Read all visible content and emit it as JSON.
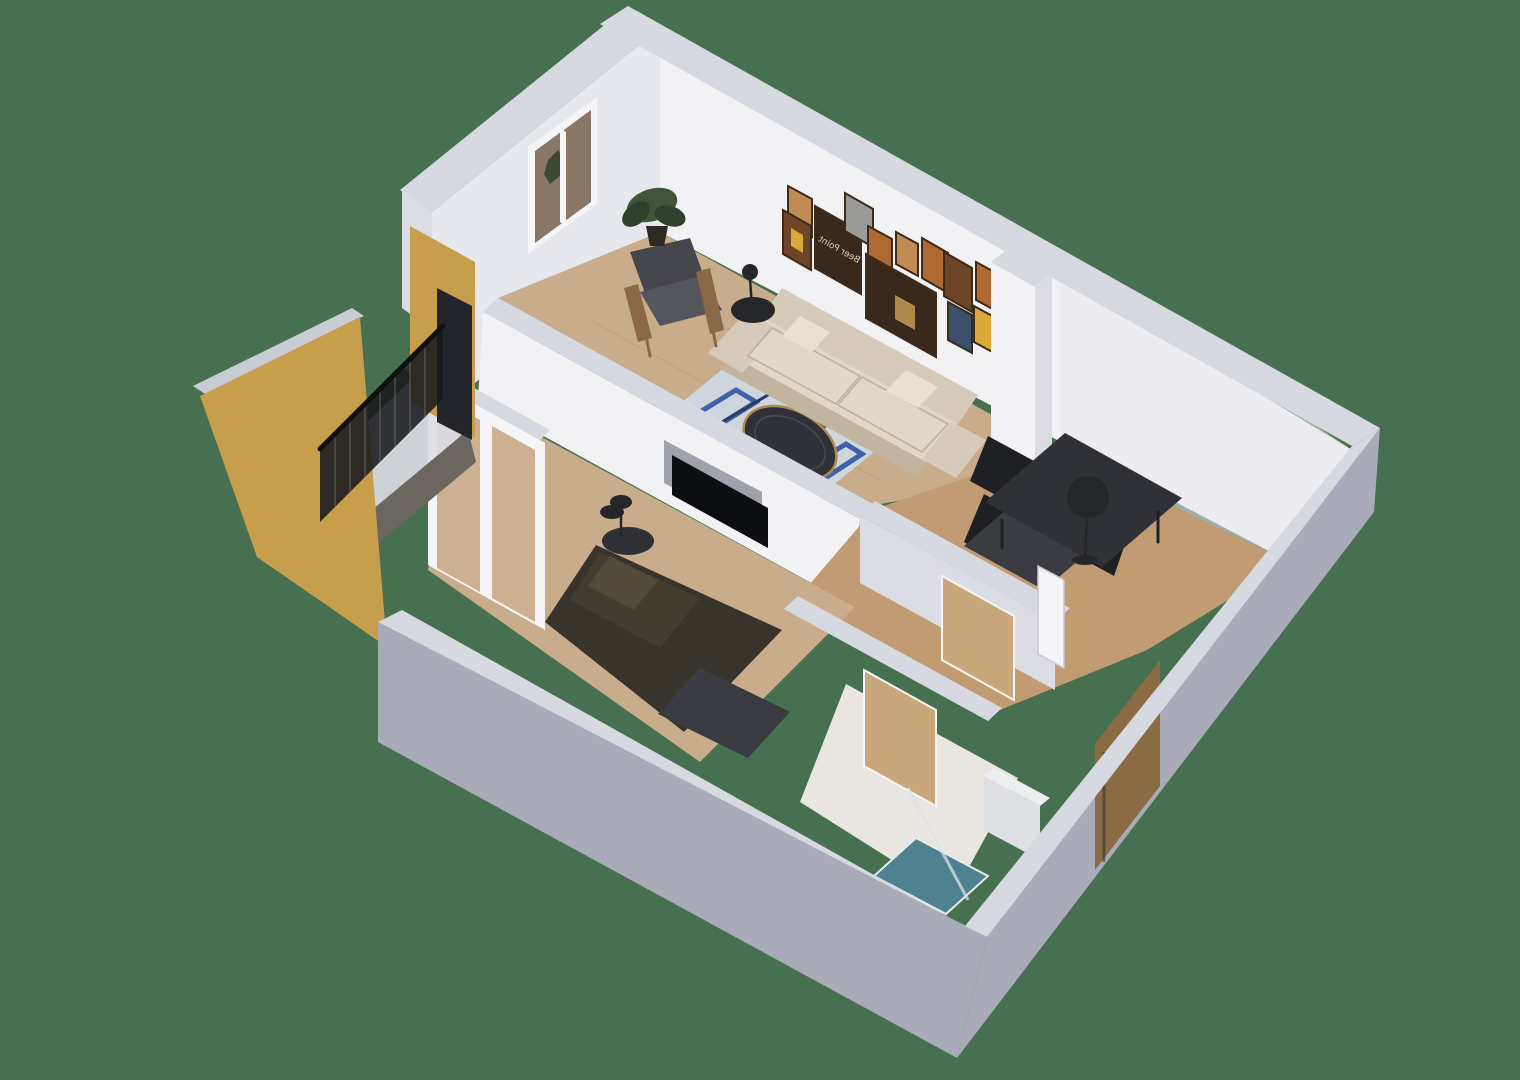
{
  "scene": {
    "title": "3D apartment dollhouse floor-plan render",
    "background_color": "#46704F",
    "wall_art_text": "Beer Point",
    "rooms": [
      {
        "name": "living-room",
        "furniture": [
          "beige sofa",
          "leather armchair",
          "floor lamp",
          "round coffee table",
          "patterned rug",
          "potted plant",
          "gallery wall posters",
          "window"
        ]
      },
      {
        "name": "dining-area",
        "furniture": [
          "dark dining table",
          "bench",
          "black chairs",
          "floor lamp"
        ]
      },
      {
        "name": "bedroom",
        "furniture": [
          "dark bed",
          "wall tv niche",
          "round side table",
          "table lamp",
          "foot bench",
          "sliding balcony door"
        ]
      },
      {
        "name": "bathroom",
        "furniture": [
          "teal shower tray",
          "white cabinet",
          "open wooden doors",
          "marble floor"
        ]
      },
      {
        "name": "hallway",
        "furniture": [
          "white door",
          "wooden entry door"
        ]
      },
      {
        "name": "balcony",
        "furniture": [
          "black metal railing",
          "yellow exterior walls"
        ]
      }
    ],
    "colors": {
      "bg": "#46704F",
      "wall_top": "#D7D9E1",
      "wall_top_dim": "#C9CBD5",
      "wall_inner": "#F2F2F5",
      "wall_inner_dim": "#E7E8ED",
      "wall_inner_shade": "#DCDDE4",
      "wall_outer": "#A9ACB8",
      "wall_outer_dark": "#999CA8",
      "yellow": "#C79E4B",
      "floor_wood": "#C9AC8B",
      "floor_wood_dim": "#C19B72",
      "floor_marble": "#E9E6E2",
      "plank": "#B3946F",
      "balcony_floor": "#6B665F",
      "rug_base": "#CFD5DD",
      "rug_blue": "#3E62A6",
      "rug_navy": "#2C3C5E",
      "sofa": "#D6CBBA",
      "sofa_light": "#E0D7C7",
      "sofa_shade": "#C2B5A0",
      "pillow": "#E8E0D1",
      "armchair": "#45464B",
      "armchair_light": "#55565C",
      "wood": "#8A6848",
      "bed": "#38332B",
      "bed_light": "#514A3A",
      "bench_dark": "#3A3C42",
      "table_dark": "#2F3137",
      "chair_black": "#1E2024",
      "lamp_black": "#26272B",
      "tv": "#0D0E11",
      "niche": "#9FA1AB",
      "gold": "#AE8A4E",
      "plant": "#41543A",
      "plant_dark": "#30402C",
      "pot": "#2D2925",
      "railing": "#17191C",
      "railing_bar": "#5E6166",
      "rail_top": "#0E1012",
      "glass_dark": "#23252B",
      "door_white": "#F5F5F7",
      "door_edge": "#C9CAD1",
      "door_wood_light": "#C8A77B",
      "door_wood": "#8B6B43",
      "teal": "#4E8290",
      "teal_rim": "#E6EAEB",
      "shower_glass": "#DCE2E4",
      "white_goods": "#EDEEF0",
      "white_goods_dim": "#DFE0E4",
      "window_glass": "#8A7866",
      "frame": "#3C2A1A",
      "poster_brown": "#6E4526",
      "poster_orange": "#AF6A33",
      "poster_tan": "#C28B54",
      "poster_dark": "#39291D",
      "poster_yellow": "#D9A93A",
      "poster_gray": "#9B9B97",
      "poster_blue": "#3A506B",
      "text_cream": "#D8CBB6",
      "shadow": "#000000"
    }
  }
}
